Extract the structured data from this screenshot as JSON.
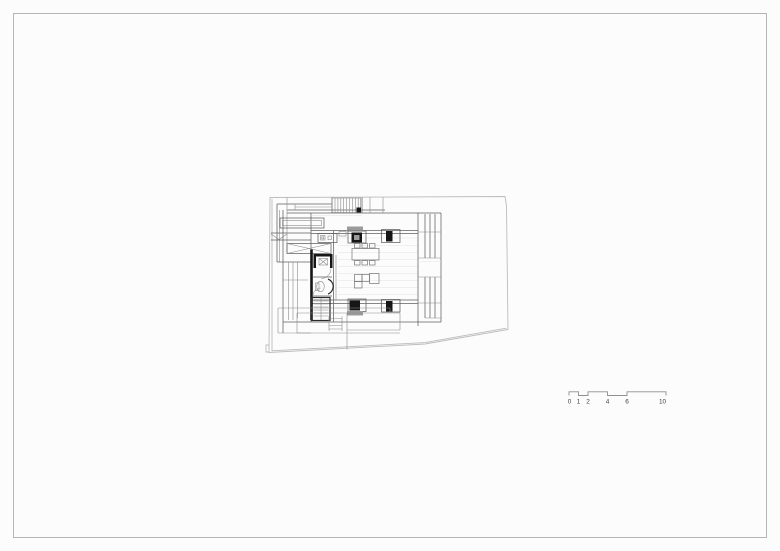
{
  "colors": {
    "paper": "#fcfcfc",
    "frame": "#b5b5b5",
    "site-line": "#bcbcbc",
    "wall-line": "#5f5f5f",
    "light-line": "#e2e2e2",
    "solid-fill": "#161616",
    "gray-fill": "#9b9b9b",
    "scale-line": "#8f8f8f",
    "scale-text": "#3f3f3f"
  },
  "scale_bar": {
    "labels": [
      "0",
      "1",
      "2",
      "4",
      "6",
      "10"
    ]
  }
}
